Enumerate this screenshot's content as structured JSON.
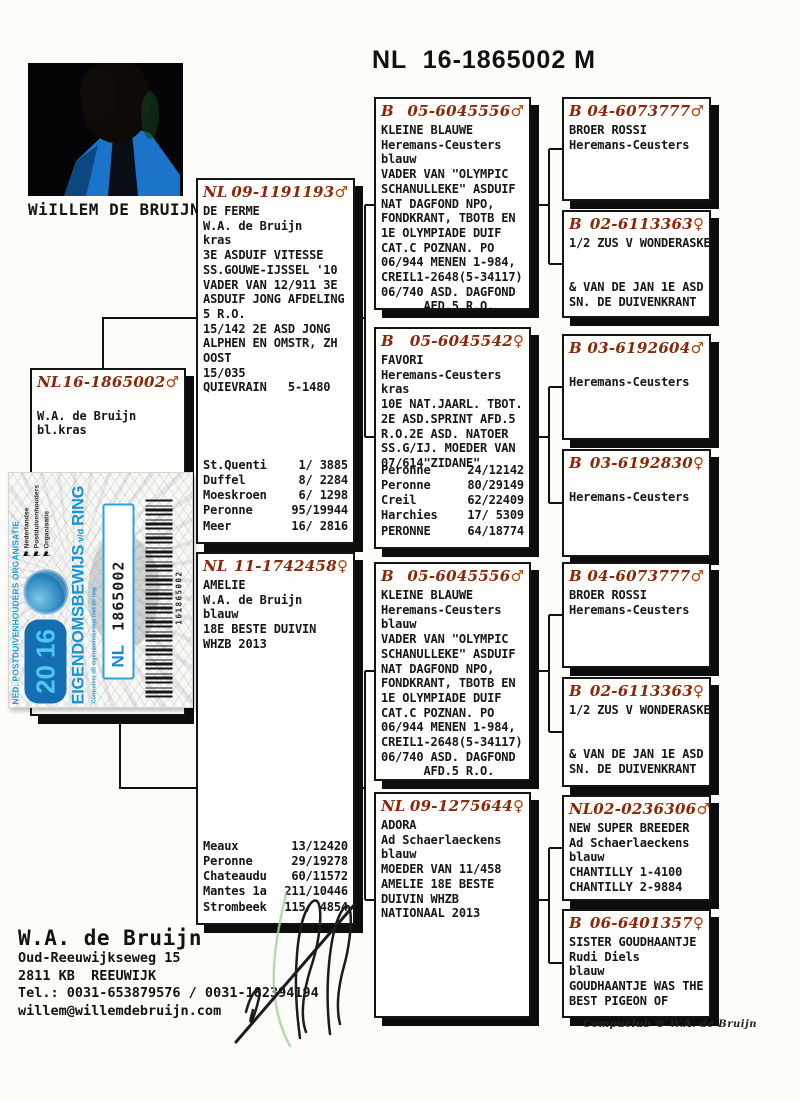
{
  "page": {
    "title": "NL  16-1865002 M",
    "photo_caption": "WiILLEM DE BRUIJN",
    "footer": "Compuclub ® W.A. de Bruijn",
    "accent_color": "#8c2608",
    "sticker_blue": "#1795d2"
  },
  "owner": {
    "name": "W.A. de Bruijn",
    "address_line1": "Oud-Reeuwijkseweg 15",
    "address_line2": "2811 KB  REEUWIJK",
    "phone_line": "Tel.: 0031-653879576 / 0031-182394194",
    "email": "willem@willemdebruijn.com"
  },
  "sticker": {
    "org_text": "NED. POSTDUIVENHOUDERS ORGANISATIE",
    "year_top": "20",
    "year_bottom": "16",
    "title": "EIGENDOMSBEWIJS",
    "title_mid": "v/d",
    "title_end": "RING",
    "country": "NL",
    "ring_number": "1865002",
    "barcode_text": "161865002",
    "npo_items": [
      "Nederlandse",
      "Postduivenhouders",
      "Organisatie"
    ],
    "note": "Controleer dit eigendomsbewijs met de ring"
  },
  "boxes": [
    {
      "country": "NL",
      "ring": "16-1865002",
      "sex": "♂",
      "lines": [
        "",
        "W.A. de Bruijn",
        "bl.kras"
      ]
    },
    {
      "country": "NL",
      "ring": "09-1191193",
      "sex": "♂",
      "lines": [
        "DE FERME",
        "W.A. de Bruijn",
        "kras",
        "3E ASDUIF VITESSE",
        "SS.GOUWE-IJSSEL '10",
        "VADER VAN 12/911 3E",
        "ASDUIF JONG AFDELING",
        "5 R.O.",
        "15/142 2E ASD JONG",
        "ALPHEN EN OMSTR, ZH",
        "OOST",
        "15/035",
        "QUIEVRAIN   5-1480"
      ],
      "races": [
        {
          "place": "St.Quenti",
          "result": " 1/ 3885"
        },
        {
          "place": "Duffel",
          "result": " 8/ 2284"
        },
        {
          "place": "Moeskroen",
          "result": " 6/ 1298"
        },
        {
          "place": "Peronne",
          "result": "95/19944"
        },
        {
          "place": "Meer",
          "result": "16/ 2816"
        }
      ]
    },
    {
      "country": "NL",
      "ring": "11-1742458",
      "sex": "♀",
      "lines": [
        "AMELIE",
        "W.A. de Bruijn",
        "blauw",
        "18E BESTE DUIVIN",
        "WHZB 2013"
      ],
      "races": [
        {
          "place": "Meaux",
          "result": " 13/12420"
        },
        {
          "place": "Peronne",
          "result": " 29/19278"
        },
        {
          "place": "Chateaudu",
          "result": " 60/11572"
        },
        {
          "place": "Mantes 1a",
          "result": "211/10446"
        },
        {
          "place": "Strombeek",
          "result": "115/ 4854"
        }
      ]
    },
    {
      "country": "B",
      "ring": "05-6045556",
      "sex": "♂",
      "lines": [
        "KLEINE BLAUWE",
        "Heremans-Ceusters",
        "blauw",
        "VADER VAN \"OLYMPIC",
        "SCHANULLEKE\" ASDUIF",
        "NAT DAGFOND NPO,",
        "FONDKRANT, TBOTB EN",
        "1E OLYMPIADE DUIF",
        "CAT.C POZNAN. PO",
        "06/944 MENEN 1-984,",
        "CREIL1-2648(5-34117)",
        "06/740 ASD. DAGFOND",
        "      AFD.5 R.O."
      ]
    },
    {
      "country": "B",
      "ring": "05-6045542",
      "sex": "♀",
      "lines": [
        "FAVORI",
        "Heremans-Ceusters",
        "kras",
        "10E NAT.JAARL. TBOT.",
        "2E ASD.SPRINT AFD.5",
        "R.O.2E ASD. NATOER",
        "SS.G/IJ. MOEDER VAN",
        "07/614\"ZIDANE\""
      ],
      "races": [
        {
          "place": "Peronne",
          "result": "24/12142"
        },
        {
          "place": "Peronne",
          "result": "80/29149"
        },
        {
          "place": "Creil",
          "result": "62/22409"
        },
        {
          "place": "Harchies",
          "result": "17/ 5309"
        },
        {
          "place": "PERONNE",
          "result": "64/18774"
        }
      ]
    },
    {
      "country": "B",
      "ring": "05-6045556",
      "sex": "♂",
      "lines": [
        "KLEINE BLAUWE",
        "Heremans-Ceusters",
        "blauw",
        "VADER VAN \"OLYMPIC",
        "SCHANULLEKE\" ASDUIF",
        "NAT DAGFOND NPO,",
        "FONDKRANT, TBOTB EN",
        "1E OLYMPIADE DUIF",
        "CAT.C POZNAN. PO",
        "06/944 MENEN 1-984,",
        "CREIL1-2648(5-34117)",
        "06/740 ASD. DAGFOND",
        "      AFD.5 R.O."
      ]
    },
    {
      "country": "NL",
      "ring": "09-1275644",
      "sex": "♀",
      "lines": [
        "ADORA",
        "Ad Schaerlaeckens",
        "blauw",
        "MOEDER VAN 11/458",
        "AMELIE 18E BESTE",
        "DUIVIN WHZB",
        "NATIONAAL 2013"
      ]
    },
    {
      "country": "B",
      "ring": "04-6073777",
      "sex": "♂",
      "lines": [
        "BROER ROSSI",
        "Heremans-Ceusters"
      ]
    },
    {
      "country": "B",
      "ring": "02-6113363",
      "sex": "♀",
      "lines": [
        "1/2 ZUS V WONDERASKE",
        "",
        "",
        "& VAN DE JAN 1E ASD",
        "SN. DE DUIVENKRANT"
      ]
    },
    {
      "country": "B",
      "ring": "03-6192604",
      "sex": "♂",
      "lines": [
        "",
        "Heremans-Ceusters"
      ]
    },
    {
      "country": "B",
      "ring": "03-6192830",
      "sex": "♀",
      "lines": [
        "",
        "Heremans-Ceusters"
      ]
    },
    {
      "country": "B",
      "ring": "04-6073777",
      "sex": "♂",
      "lines": [
        "BROER ROSSI",
        "Heremans-Ceusters"
      ]
    },
    {
      "country": "B",
      "ring": "02-6113363",
      "sex": "♀",
      "lines": [
        "1/2 ZUS V WONDERASKE",
        "",
        "",
        "& VAN DE JAN 1E ASD",
        "SN. DE DUIVENKRANT"
      ]
    },
    {
      "country": "NL",
      "ring": "02-0236306",
      "sex": "♂",
      "lines": [
        "NEW SUPER BREEDER",
        "Ad Schaerlaeckens",
        "blauw",
        "CHANTILLY 1-4100",
        "CHANTILLY 2-9884"
      ]
    },
    {
      "country": "B",
      "ring": "06-6401357",
      "sex": "♀",
      "lines": [
        "SISTER GOUDHAANTJE",
        "Rudi Diels",
        "blauw",
        "GOUDHAANTJE WAS THE",
        "BEST PIGEON OF"
      ]
    }
  ]
}
